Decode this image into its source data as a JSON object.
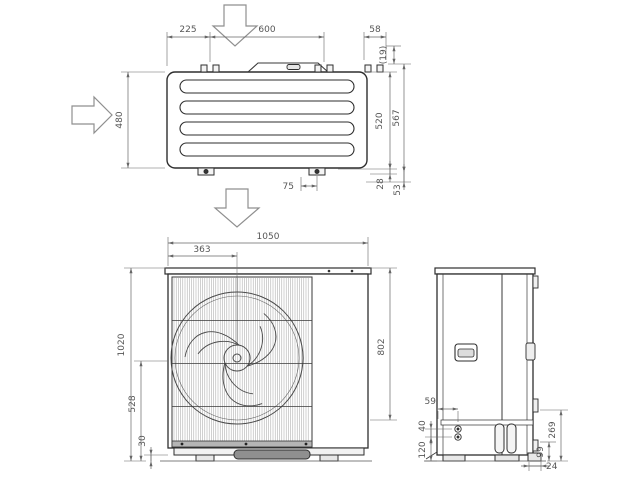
{
  "colors": {
    "line": "#2e2e2e",
    "dim_line": "#666666",
    "dim_text": "#565656",
    "arrow_outline": "#8a8a8a",
    "background": "#ffffff"
  },
  "icons": {
    "airflow_top": "hollow-down-arrow",
    "airflow_side": "hollow-right-arrow",
    "airflow_front": "hollow-down-arrow"
  },
  "top_view": {
    "dims": {
      "foot_left": "225",
      "foot_pitch": "600",
      "bracket_width": "58",
      "rear_offset": "(19)",
      "depth": "480",
      "depth_to_foot": "520",
      "depth_overall": "567",
      "foot_slot": "75",
      "foot_height": "28",
      "overall_drop": "53"
    }
  },
  "front_view": {
    "dims": {
      "width": "1050",
      "fan_center_from_left": "363",
      "height": "1020",
      "pipe_height": "528",
      "foot_height": "30",
      "panel_height": "802"
    }
  },
  "side_view": {
    "dims": {
      "pipe_offset": "59",
      "pipe_pitch": "40",
      "bottom_clearance": "120",
      "valve_height": "269",
      "drain_height": "99",
      "foot_inset": "24"
    }
  }
}
